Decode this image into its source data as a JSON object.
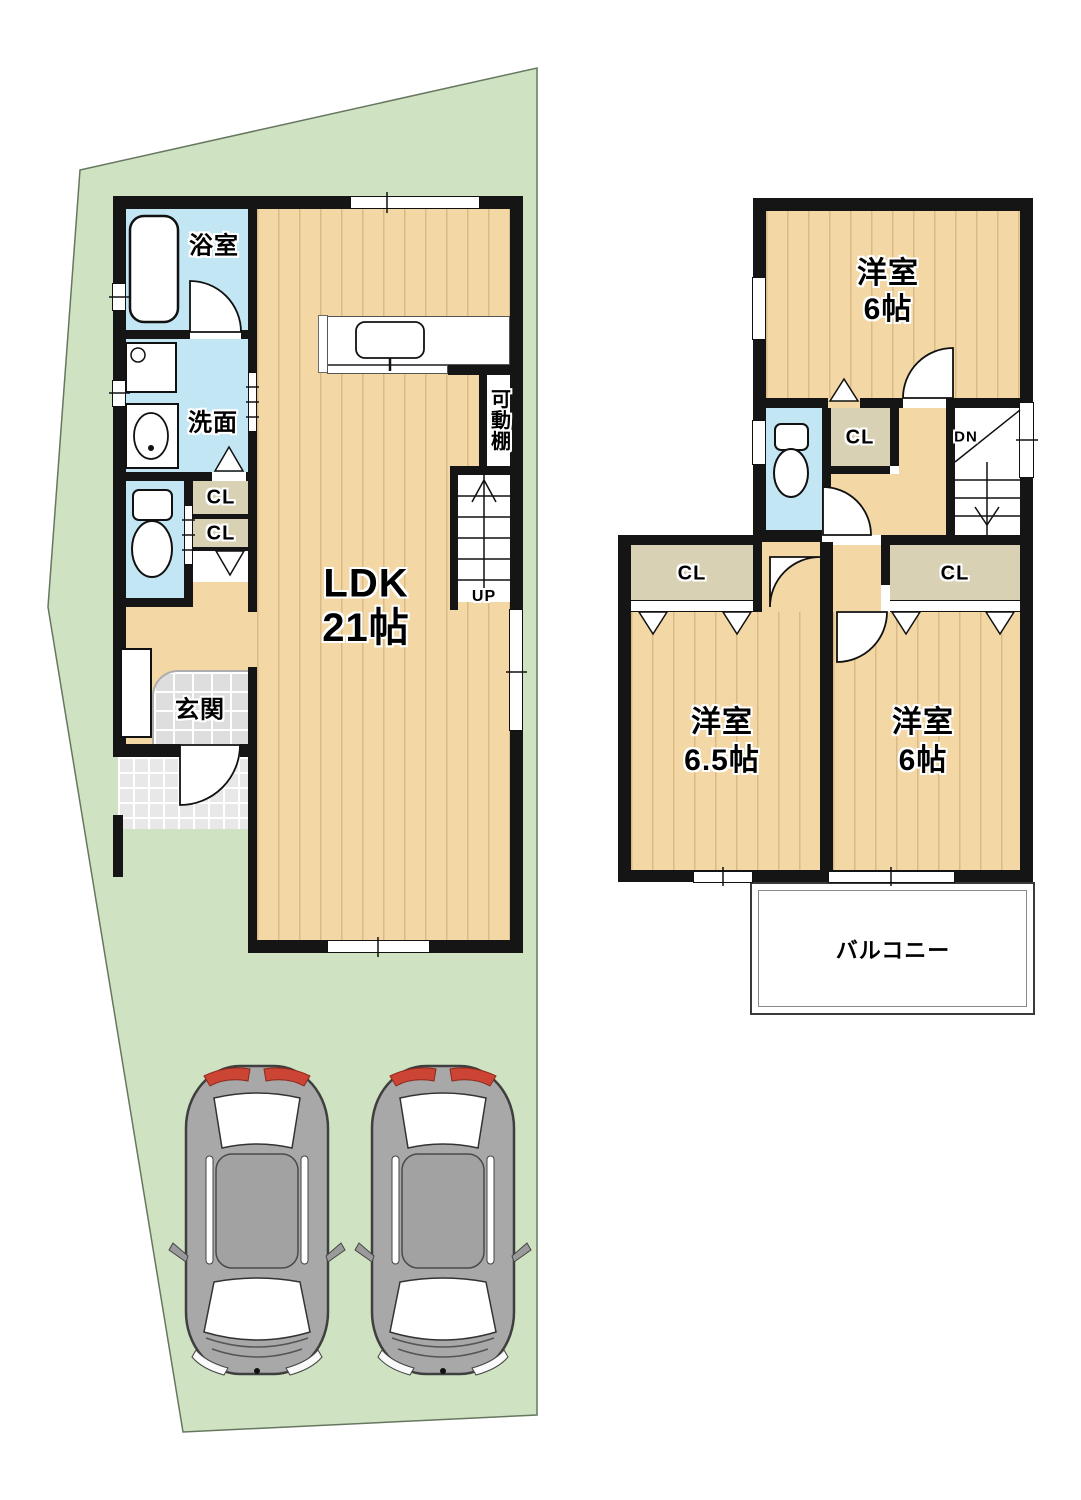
{
  "colors": {
    "lot_green": "#cfe2c2",
    "wood_floor": "#f3d8a6",
    "water_blue": "#c3e6f4",
    "closet_beige": "#d8d1b4",
    "wall_black": "#151515",
    "entrance_tile": "#dedede",
    "car_gray": "#a8a8a8",
    "taillight_red": "#cc4433"
  },
  "floor1": {
    "bath": "浴室",
    "washroom": "洗面",
    "closet_a": "CL",
    "closet_b": "CL",
    "entrance": "玄関",
    "ldk_name": "LDK",
    "ldk_size": "21帖",
    "movable_shelf": "可動棚",
    "stairs": "UP"
  },
  "floor2": {
    "room_top_name": "洋室",
    "room_top_size": "6帖",
    "closet_top": "CL",
    "stairs": "DN",
    "closet_left": "CL",
    "closet_right": "CL",
    "room_left_name": "洋室",
    "room_left_size": "6.5帖",
    "room_right_name": "洋室",
    "room_right_size": "6帖",
    "balcony": "バルコニー"
  }
}
